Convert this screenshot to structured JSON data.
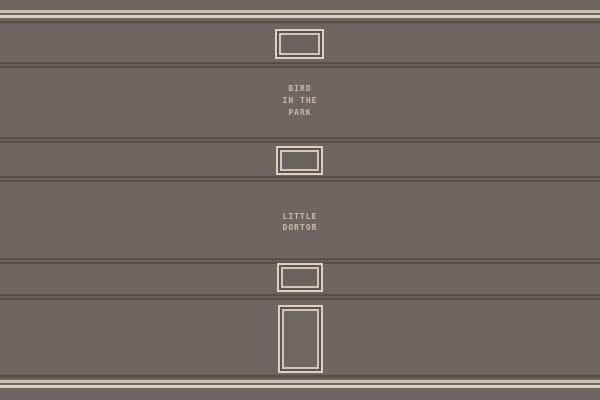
{
  "palette": {
    "wall_background": "#6e6761",
    "trim_cream_light": "#c9c2b4",
    "trim_cream_bright": "#d8d2c4",
    "trim_dark": "#564f48",
    "groove_dark": "#57504a",
    "groove_mid": "#6a635c",
    "frame_border": "#d8d2c5",
    "frame_gap": "#5c544d",
    "frame_interior": "#6b645e",
    "sign_text": "#c7beb0"
  },
  "signs": [
    {
      "id": "bird-in-the-park",
      "lines": [
        "BIRD",
        "IN THE",
        "PARK"
      ]
    },
    {
      "id": "little-dortor",
      "lines": [
        "LITTLE",
        "DORTOR"
      ]
    }
  ],
  "frames": [
    {
      "id": "framed-window-1",
      "kind": "small-frame"
    },
    {
      "id": "framed-window-2",
      "kind": "small-frame"
    },
    {
      "id": "framed-window-3",
      "kind": "small-frame"
    },
    {
      "id": "door",
      "kind": "door"
    }
  ]
}
